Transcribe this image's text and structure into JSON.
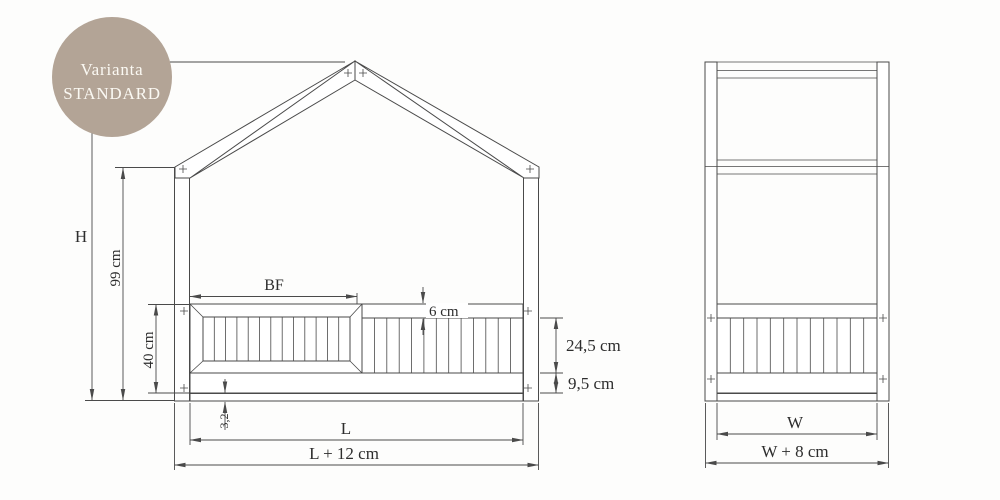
{
  "badge": {
    "line1": "Varianta",
    "line2": "STANDARD"
  },
  "front_view": {
    "dim_total_height": "H",
    "dim_wall_height": "99 cm",
    "dim_bed_side_height": "40 cm",
    "dim_top_rail_height": "6 cm",
    "dim_slat_section_height": "24,5 cm",
    "dim_bottom_rail_height": "9,5 cm",
    "dim_base_board_thickness": "3,2",
    "dim_barrier_width": "BF",
    "dim_inner_length": "L",
    "dim_outer_length": "L + 12 cm"
  },
  "side_view": {
    "dim_inner_width": "W",
    "dim_outer_width": "W + 8 cm"
  },
  "colors": {
    "badge_bg": "#b3a496",
    "badge_text": "#fbf9f3",
    "line": "#4a4a4a"
  }
}
